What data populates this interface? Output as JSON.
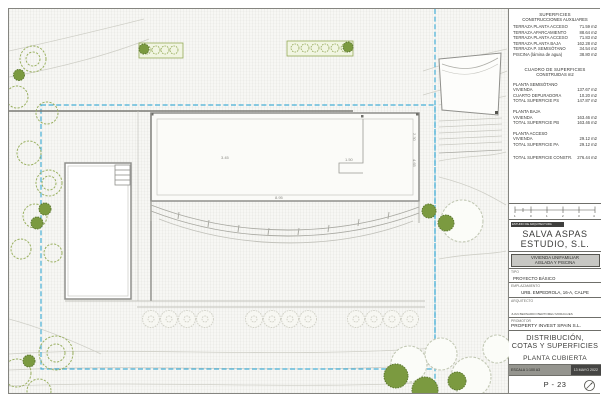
{
  "plan": {
    "dimensions": [
      "1.50",
      "2.30",
      "4.65",
      "8.95",
      "3.45"
    ]
  },
  "titleblock": {
    "superficies": {
      "title": "SUPERFICIES",
      "subtitle": "CONSTRUCCIONES AUXILIARES",
      "rows": [
        {
          "label": "TERRAZA PLANTA ACCESO",
          "value": "71.59 m2"
        },
        {
          "label": "TERRAZA APARCAMIENTO",
          "value": "88.64 m2"
        },
        {
          "label": "TERRAZA PLANTA ACCESO",
          "value": "71.83 m2"
        },
        {
          "label": "TERRAZA PLANTA BAJA",
          "value": "162.28 m2"
        },
        {
          "label": "TERRAZA P. SEMISÓTANO",
          "value": "34.54 m2"
        },
        {
          "label": "PISCINA (lámina de agua)",
          "value": "38.80 m2"
        }
      ]
    },
    "cuadro": {
      "title": "CUADRO DE SUPERFICIES",
      "subtitle": "CONSTRUIDAS m2",
      "g1_heading": "PLANTA SEMISÓTANO",
      "g1_rows": [
        {
          "label": "VIVIENDA",
          "value": "137.67 m2"
        },
        {
          "label": "CUARTO DEPURADORA",
          "value": "10.20 m2"
        },
        {
          "label": "TOTAL SUPERFICIE PS",
          "value": "147.87 m2"
        }
      ],
      "g2_heading": "PLANTA BAJA",
      "g2_rows": [
        {
          "label": "VIVIENDA",
          "value": "163.46 m2"
        },
        {
          "label": "TOTAL SUPERFICIE PB",
          "value": "163.46 m2"
        }
      ],
      "g3_heading": "PLANTA ACCESO",
      "g3_rows": [
        {
          "label": "VIVIENDA",
          "value": "29.12 m2"
        },
        {
          "label": "TOTAL SUPERFICIE PA",
          "value": "29.12 m2"
        }
      ],
      "total": {
        "label": "TOTAL SUPERFICIE CONSTR.",
        "value": "276.44 m2"
      }
    },
    "scalebar": {
      "labels": [
        "1",
        "0",
        "1",
        "2",
        "3",
        "4"
      ]
    },
    "firm": {
      "tag": "ESTUDIO DE ARQUITECTURA",
      "name_line1": "SALVA ASPAS",
      "name_line2": "ESTUDIO, S.L."
    },
    "project": {
      "line1": "VIVIENDA UNIFAMILIAR",
      "line2": "AISLADA Y PISCINA"
    },
    "tipo": {
      "label": "TIPO",
      "value": "PROYECTO BÁSICO"
    },
    "emplazamiento": {
      "label": "EMPLAZAMIENTO",
      "value": "URB. EMPEDROLA, 16-A, CALPE"
    },
    "arquitecto": {
      "label": "ARQUITECTO",
      "name": "JUAN BERNARDO BERTOMEU MORAGUES"
    },
    "promotor": {
      "label": "PROMOTOR",
      "value": "PROPERTY INVEST SPAIN S.L."
    },
    "sheet": {
      "title_line1": "DISTRIBUCIÓN,",
      "title_line2": "COTAS Y SUPERFICIES",
      "subtitle": "PLANTA CUBIERTA",
      "escala": "ESCALA  1:100  A3",
      "fecha": "13 MAYO 2022",
      "number": "P - 23"
    },
    "colors": {
      "boundary_dash": "#45aed6",
      "tree_green": "#7b9a40",
      "line_gray": "#8f8f8b"
    }
  }
}
